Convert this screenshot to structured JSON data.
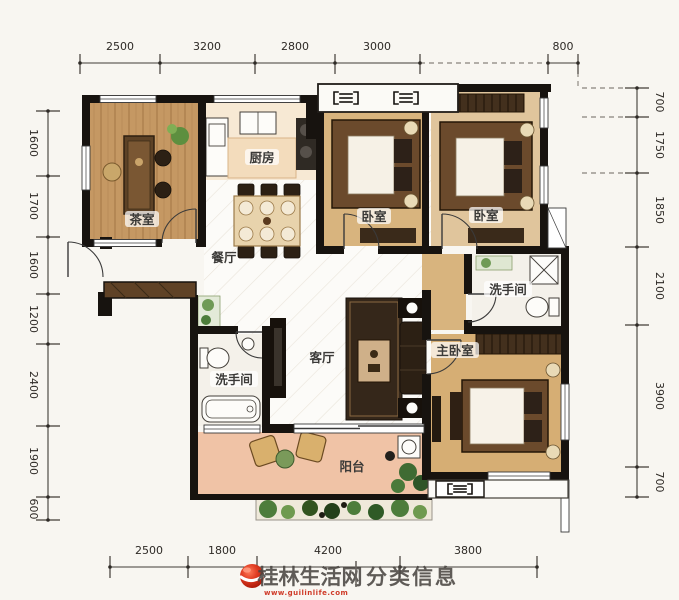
{
  "colors": {
    "wall": "#17130f",
    "accent_red": "#d0392b",
    "balcony_floor": "#f0c3a6",
    "wood_floor": "#c59863",
    "bedroom_floor": "#d8b47e"
  },
  "dimensions": {
    "top": [
      "2500",
      "3200",
      "2800",
      "3000",
      "800"
    ],
    "left": [
      "1600",
      "1700",
      "1600",
      "1200",
      "2400",
      "1900",
      "600"
    ],
    "right": [
      "700",
      "1750",
      "1850",
      "2100",
      "3900",
      "700"
    ],
    "bottom": [
      "2500",
      "1800",
      "4200",
      "3800"
    ]
  },
  "rooms": {
    "tea_room": "茶室",
    "kitchen": "厨房",
    "dining": "餐厅",
    "bedroom_1": "卧室",
    "bedroom_2": "卧室",
    "living": "客厅",
    "bathroom_1": "洗手间",
    "bathroom_2": "洗手间",
    "master_bedroom": "主卧室",
    "balcony": "阳台"
  },
  "icons": {
    "ac_unit": "outdoor-ac-unit",
    "logo": "red-sphere-swoosh"
  },
  "watermark": {
    "site": "桂林生活网",
    "separator": "|",
    "tagline": "分类信息",
    "url": "www.guilinlife.com"
  }
}
